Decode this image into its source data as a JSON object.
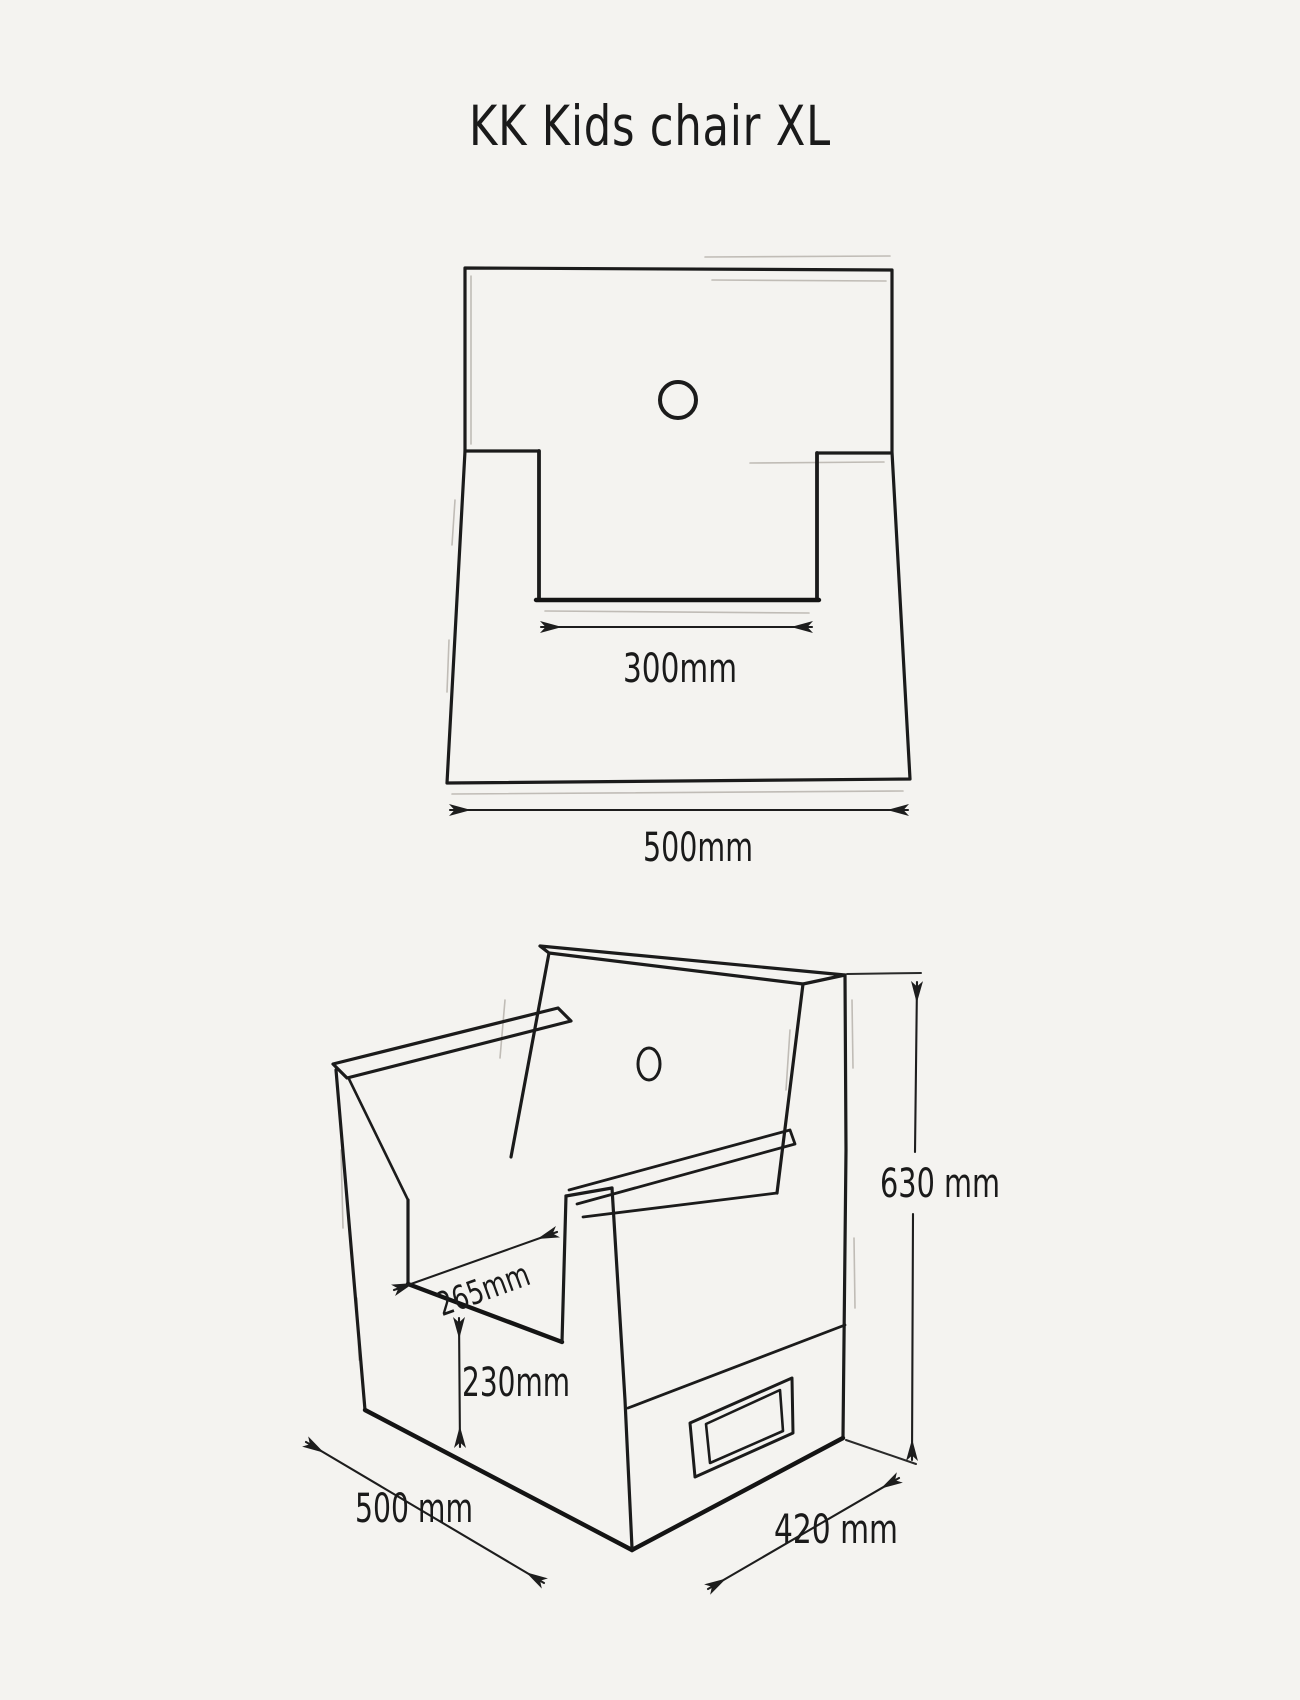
{
  "title": "KK  Kids chair XL",
  "front_view": {
    "name": "front orthographic view of chair",
    "dim_notch_width": "300mm",
    "dim_overall_width": "500mm"
  },
  "iso_view": {
    "name": "isometric view of chair",
    "dim_height": "630 mm",
    "dim_seat_depth": "265mm",
    "dim_seat_height": "230mm",
    "dim_width": "500 mm",
    "dim_depth": "420 mm"
  },
  "colors": {
    "background": "#f4f3f0",
    "line": "#1b1b1b",
    "ghost": "#b3aea8"
  }
}
